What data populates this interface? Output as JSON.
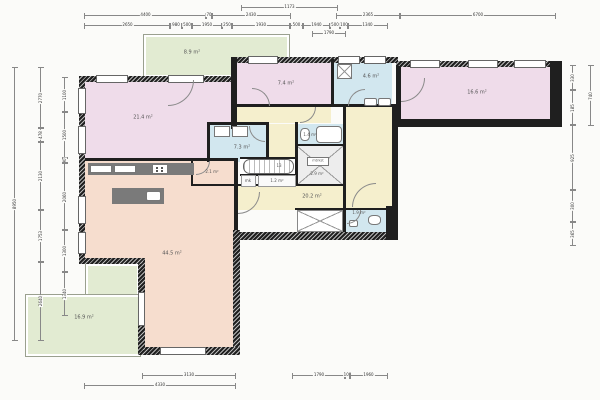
{
  "drawing": {
    "type": "architectural floor plan",
    "units": "mm"
  },
  "colors": {
    "bedroom_pink": "#efdcea",
    "terrace_green": "#e2ebd2",
    "bath_blue": "#d2e7ef",
    "hall_yellow": "#f5efcd",
    "living_peach": "#f6ddce",
    "wall_black": "#1f1f1f",
    "kitchen_counter_gray": "#7a7a7a"
  },
  "rooms": {
    "terrace_top": {
      "area": "8.9 m²"
    },
    "bedroom_left": {
      "area": "21.4 m²"
    },
    "bedroom_mid": {
      "area": "7.4 m²"
    },
    "bathroom_main": {
      "area": "4.6 m²"
    },
    "bedroom_right": {
      "area": "16.6 m²"
    },
    "shower_room": {
      "area": "7.3 m²"
    },
    "bath_tub_room": {
      "area": "1.4 m²"
    },
    "storage": {
      "area": "2.9 m²"
    },
    "pantry": {
      "area": "2.1 m²"
    },
    "closet": {
      "area": "1.2 m²"
    },
    "hallway": {
      "area": "20.2 m²"
    },
    "toilet": {
      "area": "1.9 m²"
    },
    "living_kitchen": {
      "area": "44.5 m²"
    },
    "terrace_garden": {
      "area": "16.9 m²"
    }
  },
  "fixtures": {
    "stairs_count": "13",
    "meter_box": "mk",
    "meter_cabinet": "mtrkst"
  },
  "dims": {
    "top0": [
      "1173"
    ],
    "top1": [
      "4400",
      "70",
      "2430",
      "2365",
      "6700"
    ],
    "top2": [
      "2650",
      "980",
      "500",
      "1950",
      "250",
      "1930",
      "500",
      "1940",
      "500",
      "100",
      "1340"
    ],
    "top3": [
      "1790"
    ],
    "left1": [
      "8950"
    ],
    "left2": [
      "2770",
      "478",
      "2130",
      "1753",
      "2640"
    ],
    "left3": [
      "1100",
      "1500",
      "90",
      "2060",
      "1300",
      "1340"
    ],
    "right1": [
      "740"
    ],
    "right2": [
      "330",
      "185",
      "925",
      "300",
      "365"
    ],
    "bottom1": [
      "3130",
      "1790",
      "100",
      "1960"
    ],
    "bottom2": [
      "4330"
    ]
  }
}
